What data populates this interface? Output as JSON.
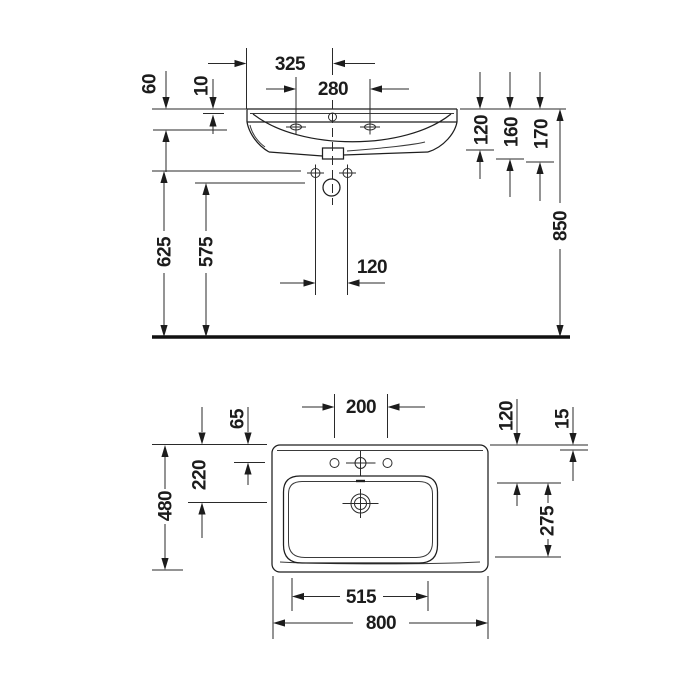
{
  "drawing_title": "Wall-mounted washbasin technical dimension drawing",
  "colors": {
    "line": "#1e1e1e",
    "background": "#ffffff"
  },
  "front": {
    "d325": "325",
    "d280": "280",
    "d60": "60",
    "d10": "10",
    "d120_right": "120",
    "d160": "160",
    "d170": "170",
    "d850": "850",
    "d625": "625",
    "d575": "575",
    "d120_bolts": "120"
  },
  "plan": {
    "d200": "200",
    "d65": "65",
    "d220": "220",
    "d480": "480",
    "d120": "120",
    "d15": "15",
    "d275": "275",
    "d515": "515",
    "d800": "800"
  }
}
